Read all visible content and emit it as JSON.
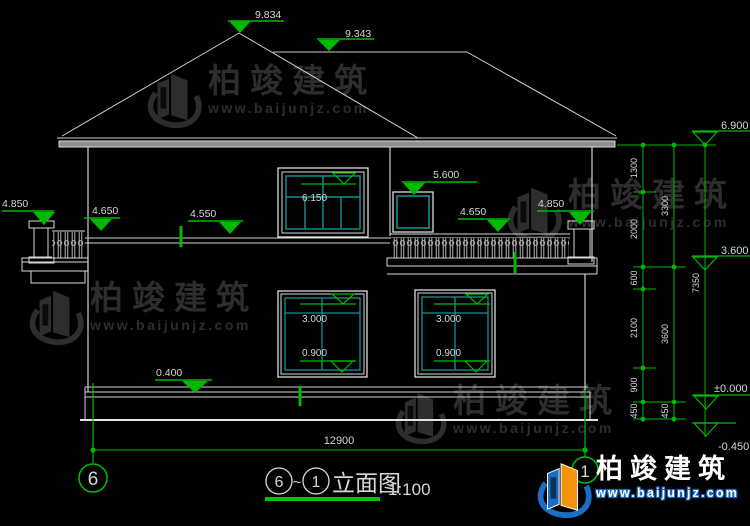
{
  "drawing": {
    "title": {
      "left_axis": "6",
      "tilde": "~",
      "right_axis": "1",
      "name": "立面图",
      "scale": "1:100"
    },
    "grid_bubbles": {
      "left": "6",
      "right": "1"
    },
    "elevation_markers": {
      "ridge_main": "9.834",
      "ridge_secondary": "9.343",
      "eave": "6.900",
      "balcony_post_left": "4.850",
      "parapet_left": "4.650",
      "floor2_left": "4.550",
      "door_top": "6.150",
      "window2_top": "5.600",
      "parapet_right": "4.650",
      "balcony_post_right": "4.850",
      "floor2_right": "3.600",
      "plinth": "0.400",
      "ground": "±0.000",
      "site": "-0.450",
      "window_top": "3.000",
      "window_sill": "0.900"
    },
    "dimensions": {
      "bottom_width": "12900",
      "right_chain_inner": [
        "1300",
        "2000",
        "600",
        "2100",
        "900",
        "450"
      ],
      "right_chain_middle": [
        "3300",
        "3600",
        "450"
      ],
      "right_chain_outer": [
        "7350"
      ]
    }
  },
  "watermark": {
    "brand": "柏竣建筑",
    "url": "www.baijunjz.com"
  },
  "logo": {
    "brand": "柏竣建筑",
    "url": "www.baijunjz.com"
  }
}
